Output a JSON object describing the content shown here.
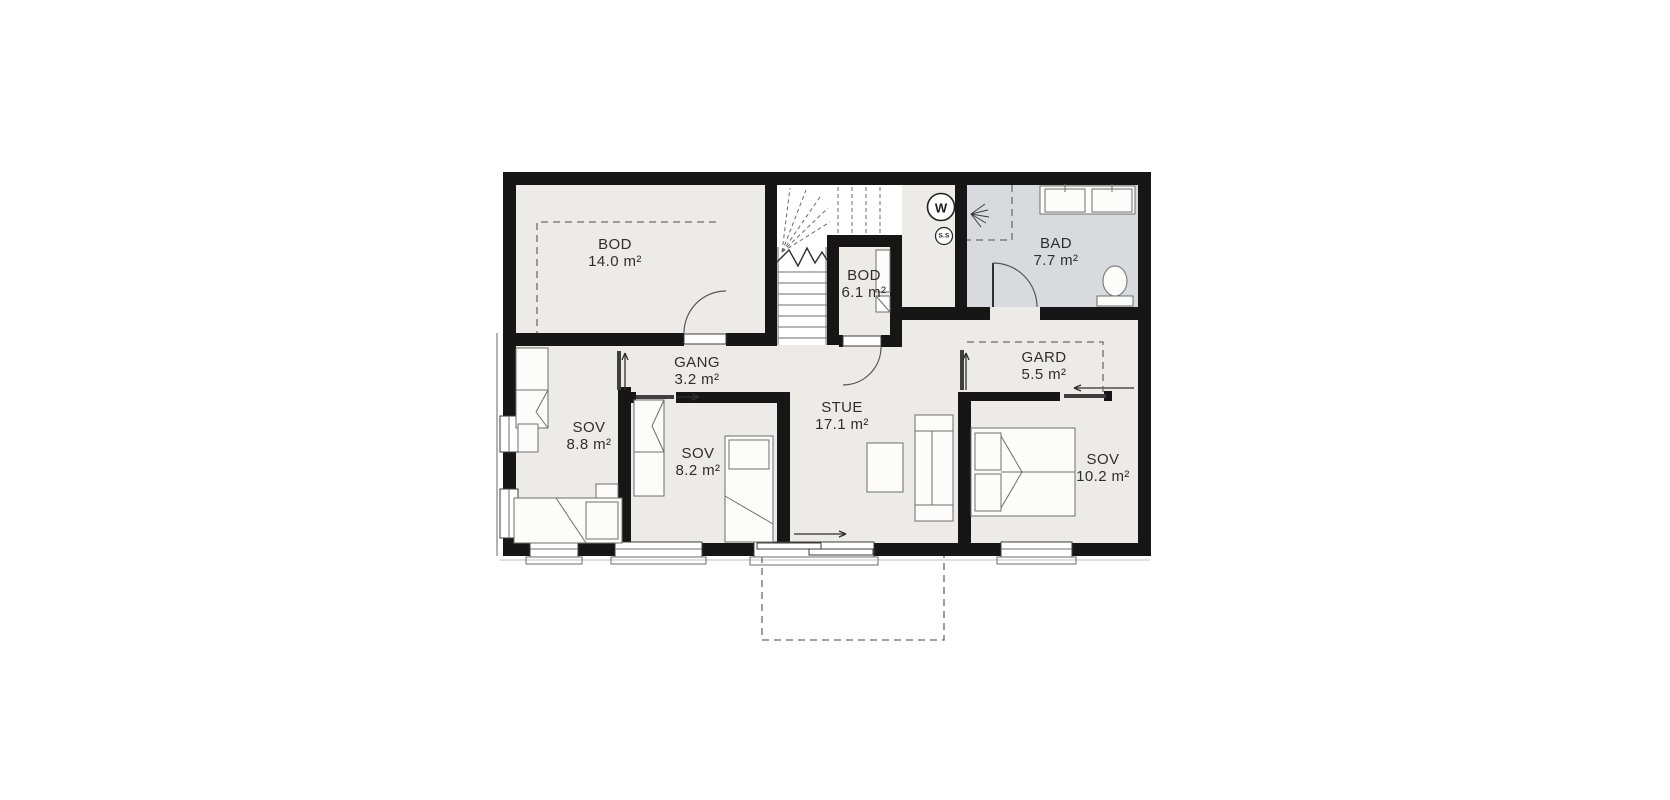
{
  "plan_title": "floor-plan",
  "rooms": {
    "bod14": {
      "name": "BOD",
      "area": "14.0 m²"
    },
    "bod61": {
      "name": "BOD",
      "area": "6.1 m²"
    },
    "bad": {
      "name": "BAD",
      "area": "7.7 m²"
    },
    "gang": {
      "name": "GANG",
      "area": "3.2 m²"
    },
    "gard": {
      "name": "GARD",
      "area": "5.5 m²"
    },
    "sov88": {
      "name": "SOV",
      "area": "8.8 m²"
    },
    "sov82": {
      "name": "SOV",
      "area": "8.2 m²"
    },
    "stue": {
      "name": "STUE",
      "area": "17.1 m²"
    },
    "sov102": {
      "name": "SOV",
      "area": "10.2 m²"
    }
  },
  "icons": {
    "washer": "W",
    "sensor": "S.S"
  },
  "colors": {
    "room_fill": "#ECEBE7",
    "bad_fill": "#D8DADD",
    "wall": "#161616",
    "dash": "#6b6b6b",
    "furniture_stroke": "#6e6e6e"
  }
}
